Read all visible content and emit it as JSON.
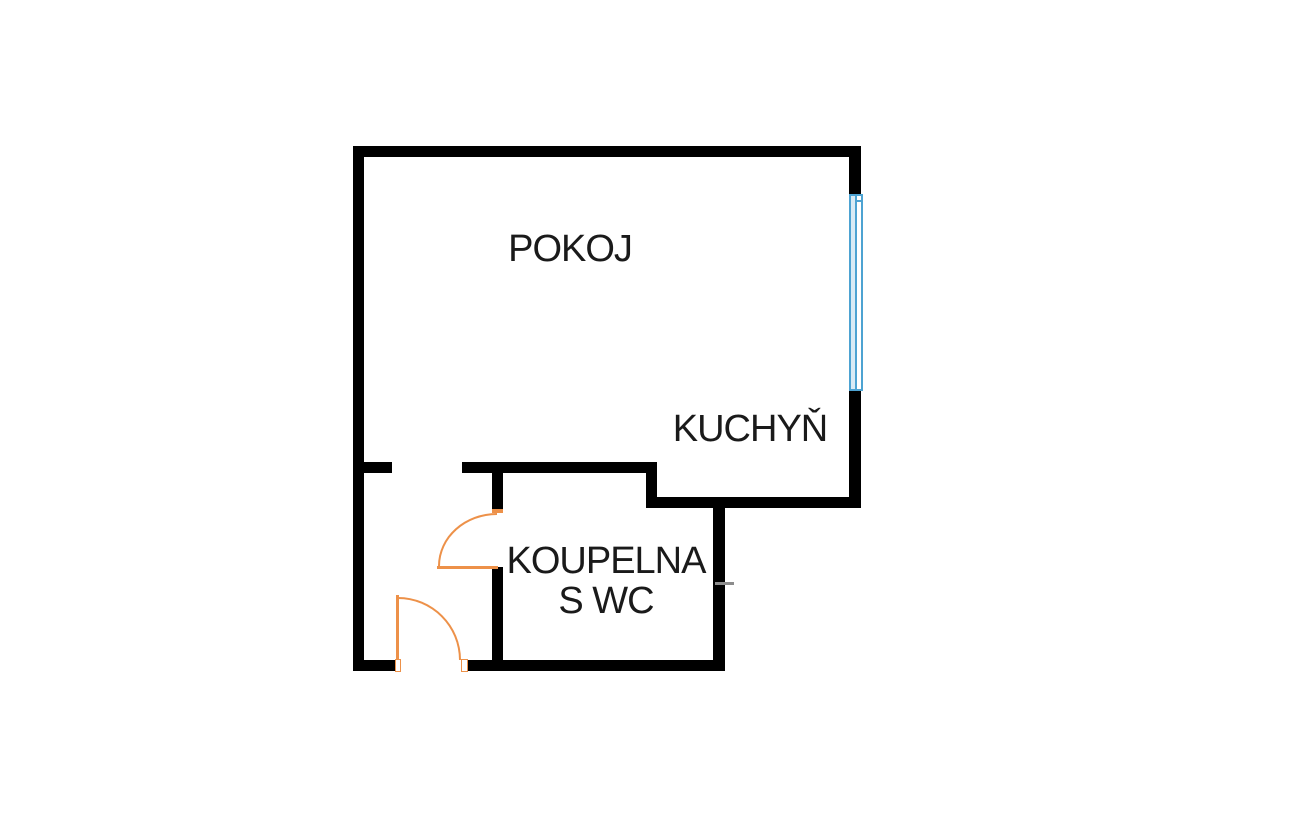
{
  "title": "Studio apartment floor plan",
  "colors": {
    "wall": "#000000",
    "door": "#ED9149",
    "window-frame": "#4DA3D2",
    "window-glass": "#D9EBF5",
    "fixture-tick": "#8C8C8C",
    "text": "#1A1A1A",
    "background": "#FFFFFF"
  },
  "rooms": [
    {
      "id": "pokoj",
      "label": "POKOJ"
    },
    {
      "id": "kuchyn",
      "label": "KUCHYŇ"
    },
    {
      "id": "koupelna",
      "label": "KOUPELNA",
      "label2": "S WC"
    }
  ]
}
